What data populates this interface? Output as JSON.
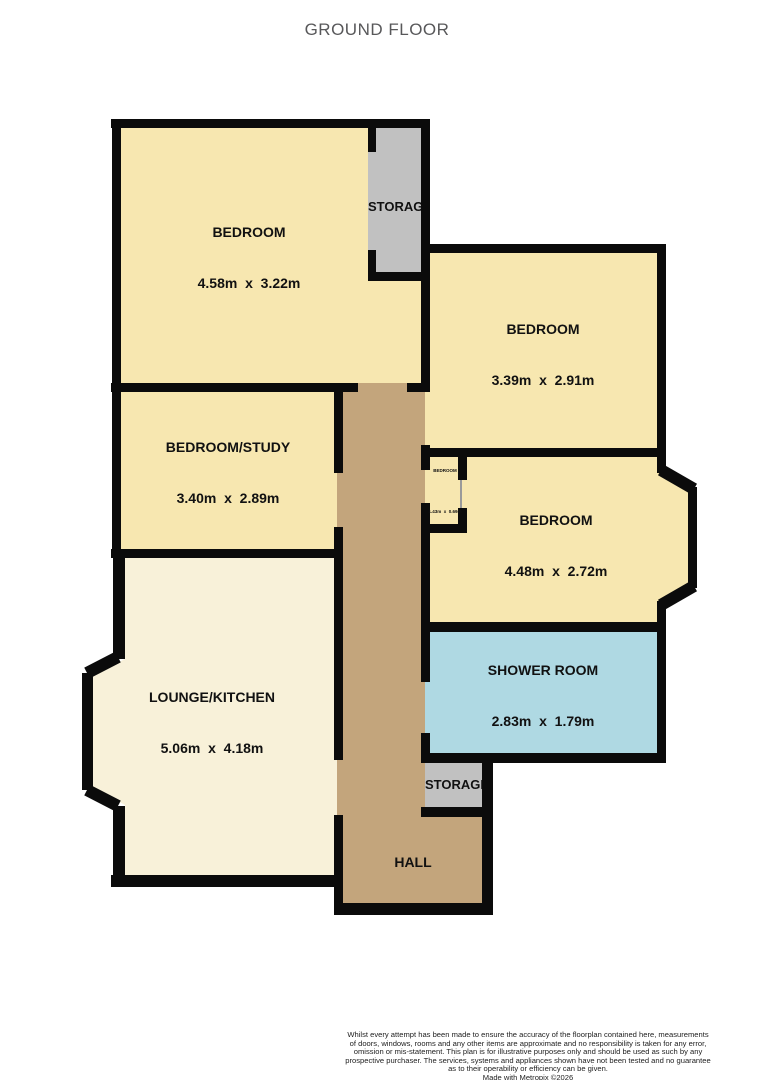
{
  "title": "GROUND FLOOR",
  "rooms": {
    "bedroom1": {
      "name": "BEDROOM",
      "dims": "4.58m  x  3.22m"
    },
    "bedroom2": {
      "name": "BEDROOM",
      "dims": "3.39m  x  2.91m"
    },
    "bedroom_study": {
      "name": "BEDROOM/STUDY",
      "dims": "3.40m  x  2.89m"
    },
    "bedroom3": {
      "name": "BEDROOM",
      "dims": "4.48m  x  2.72m"
    },
    "bedroom_small": {
      "name": "BEDROOM",
      "dims": "1.43m  x  0.69m"
    },
    "shower_room": {
      "name": "SHOWER ROOM",
      "dims": "2.83m  x  1.79m"
    },
    "lounge_kitchen": {
      "name": "LOUNGE/KITCHEN",
      "dims": "5.06m  x  4.18m"
    },
    "hall": {
      "name": "HALL"
    },
    "storage_top": {
      "name": "STORAGE"
    },
    "storage_bottom": {
      "name": "STORAGE"
    }
  },
  "colors": {
    "bedroom": "#F7E7B0",
    "lounge": "#F8F1D9",
    "hall": "#C3A57C",
    "shower": "#AFD9E3",
    "storage": "#C1C1C1",
    "wall": "#0B0B0B",
    "door_line": "#9A9A9A"
  },
  "footer": {
    "lines": [
      "Whilst every attempt has been made to ensure the accuracy of the floorplan contained here, measurements",
      "of doors, windows, rooms and any other items are approximate and no responsibility is taken for any error,",
      "omission or mis-statement. This plan is for illustrative purposes only and should be used as such by any",
      "prospective purchaser. The services, systems and appliances shown have not been tested and no guarantee",
      "as to their operability or efficiency can be given.",
      "Made with Metropix ©2026"
    ]
  }
}
